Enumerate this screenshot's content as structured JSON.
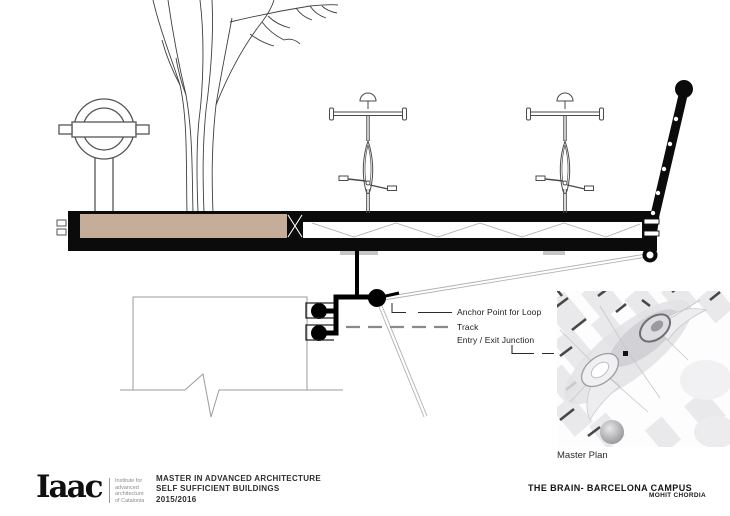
{
  "annotations": {
    "anchor_point": "Anchor Point for Loop",
    "track": "Track",
    "entry_exit": "Entry / Exit Junction"
  },
  "master_plan": {
    "caption": "Master Plan"
  },
  "footer": {
    "logo_text": "Iaac",
    "logo_org_lines": [
      "Institute for",
      "advanced",
      "architecture",
      "of Catalonia"
    ],
    "program_lines": [
      "MASTER IN ADVANCED ARCHITECTURE",
      "SELF SUFFICIENT BUILDINGS",
      "2015/2016"
    ],
    "project_title": "THE BRAIN- BARCELONA CAMPUS",
    "project_author": "MOHIT CHORDIA"
  },
  "colors": {
    "soil": "#c5ad9a",
    "ink": "#0b0b0b",
    "leader_gray": "#8a8a8a",
    "wall_gray": "#9b9b9b",
    "cable_gray": "#b2b2b2",
    "map_block_gray": "#e9e9eb"
  }
}
